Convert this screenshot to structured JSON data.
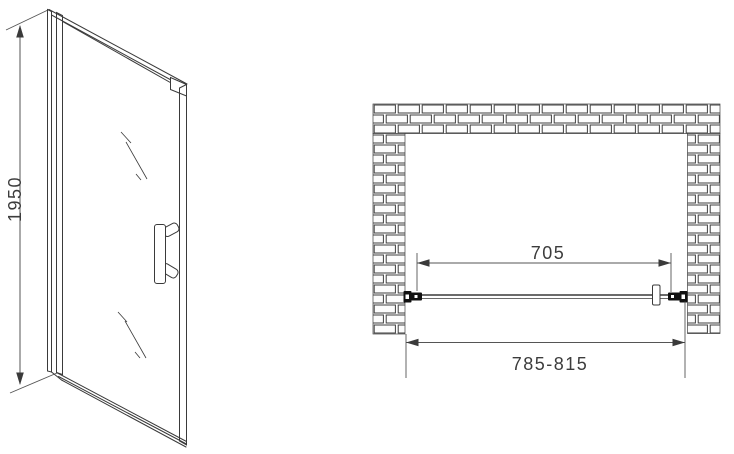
{
  "views": {
    "door_elevation": {
      "height_dimension": "1950"
    },
    "plan": {
      "glass_width_dimension": "705",
      "opening_width_dimension": "785-815"
    }
  },
  "colors": {
    "line": "#3a3a3a",
    "dim": "#555555",
    "fitting": "#111111",
    "background": "#ffffff",
    "text": "#3c3c3c"
  }
}
